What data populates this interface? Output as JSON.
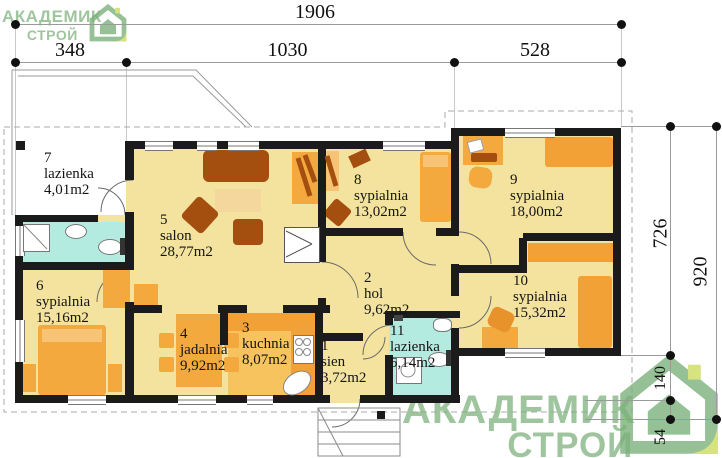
{
  "watermark": {
    "line1": "АКАДЕМИК",
    "line2": "СТРОЙ",
    "green": "#7db27c",
    "accent": "#cddd60"
  },
  "dimensions": {
    "total_width": "1906",
    "top_segments": [
      "348",
      "1030",
      "528"
    ],
    "right_inner": "726",
    "right_inner_lower": [
      "140",
      "54"
    ],
    "right_outer": "920"
  },
  "rooms": [
    {
      "number": "1",
      "name": "sien",
      "area": "3,72m2"
    },
    {
      "number": "2",
      "name": "hol",
      "area": "9,62m2"
    },
    {
      "number": "3",
      "name": "kuchnia",
      "area": "8,07m2"
    },
    {
      "number": "4",
      "name": "jadalnia",
      "area": "9,92m2"
    },
    {
      "number": "5",
      "name": "salon",
      "area": "28,77m2"
    },
    {
      "number": "6",
      "name": "sypialnia",
      "area": "15,16m2"
    },
    {
      "number": "7",
      "name": "lazienka",
      "area": "4,01m2"
    },
    {
      "number": "8",
      "name": "sypialnia",
      "area": "13,02m2"
    },
    {
      "number": "9",
      "name": "sypialnia",
      "area": "18,00m2"
    },
    {
      "number": "10",
      "name": "sypialnia",
      "area": "15,32m2"
    },
    {
      "number": "11",
      "name": "lazienka",
      "area": "5,14m2"
    }
  ],
  "colors": {
    "floor": "#f3e39e",
    "kitchen_floor": "#f6c35f",
    "bath": "#b4ebe1",
    "furniture": "#f3a93e",
    "furniture_dark": "#f2a136",
    "furniture_light": "#f7c476",
    "wood": "#a44f10",
    "wall": "#1b1b1b"
  }
}
